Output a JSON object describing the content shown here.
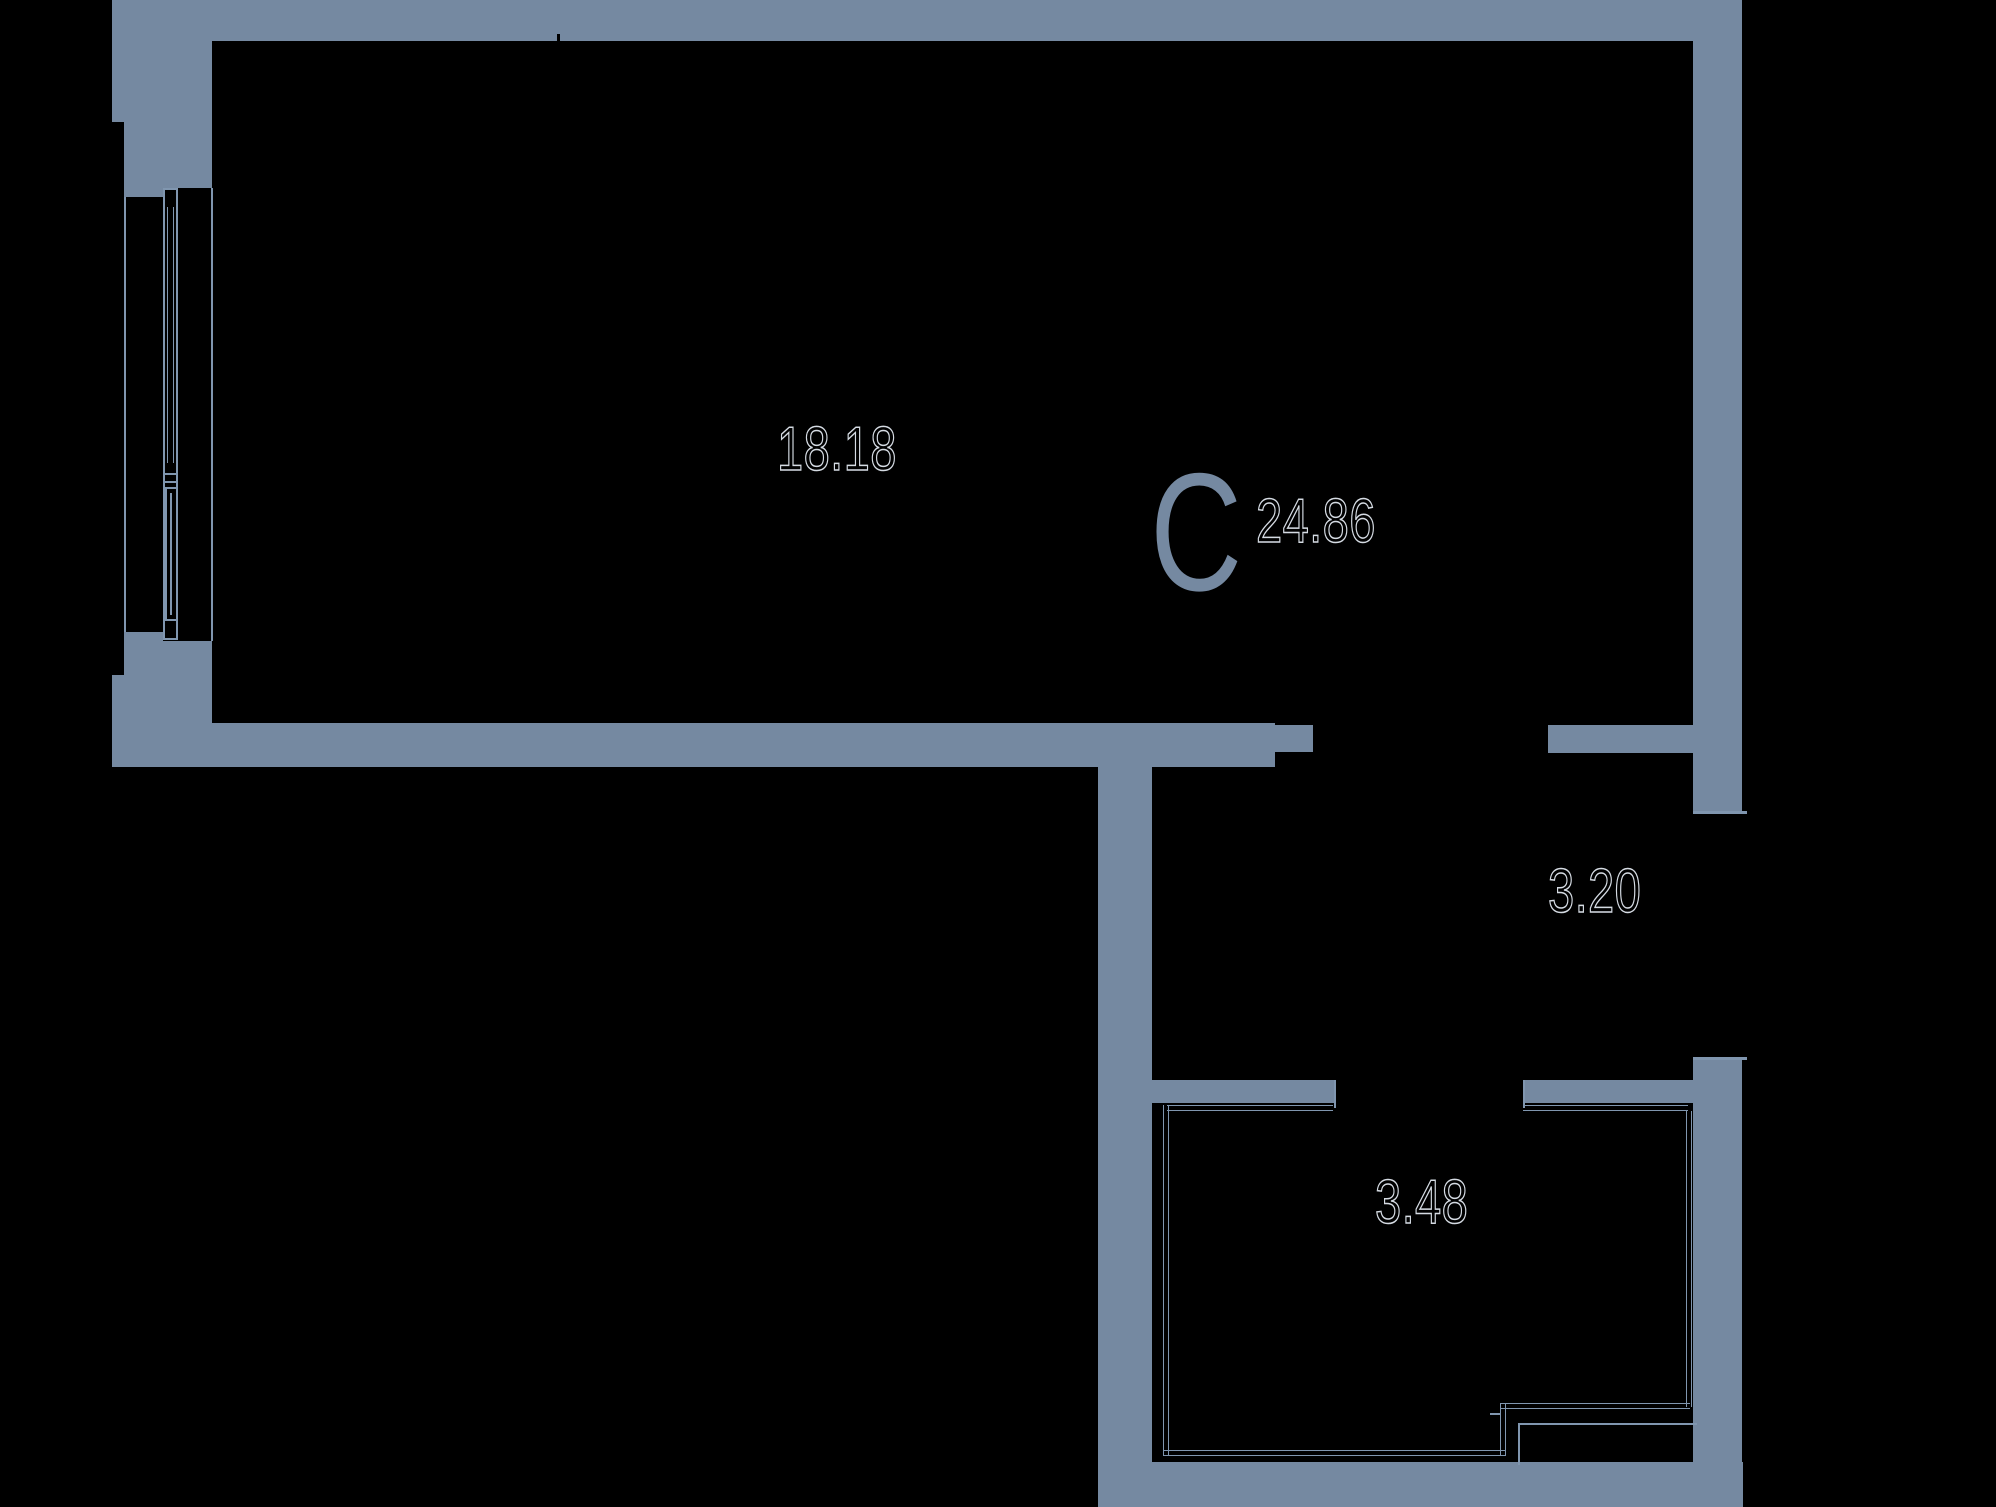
{
  "plan": {
    "title_label": "C",
    "areas": {
      "living_room": "18.18",
      "total": "24.86",
      "hallway": "3.20",
      "bathroom": "3.48"
    },
    "colors": {
      "wall": "#7589a1",
      "line": "#8096af",
      "numbers": "#d5dbe3",
      "background": "#000000"
    }
  }
}
